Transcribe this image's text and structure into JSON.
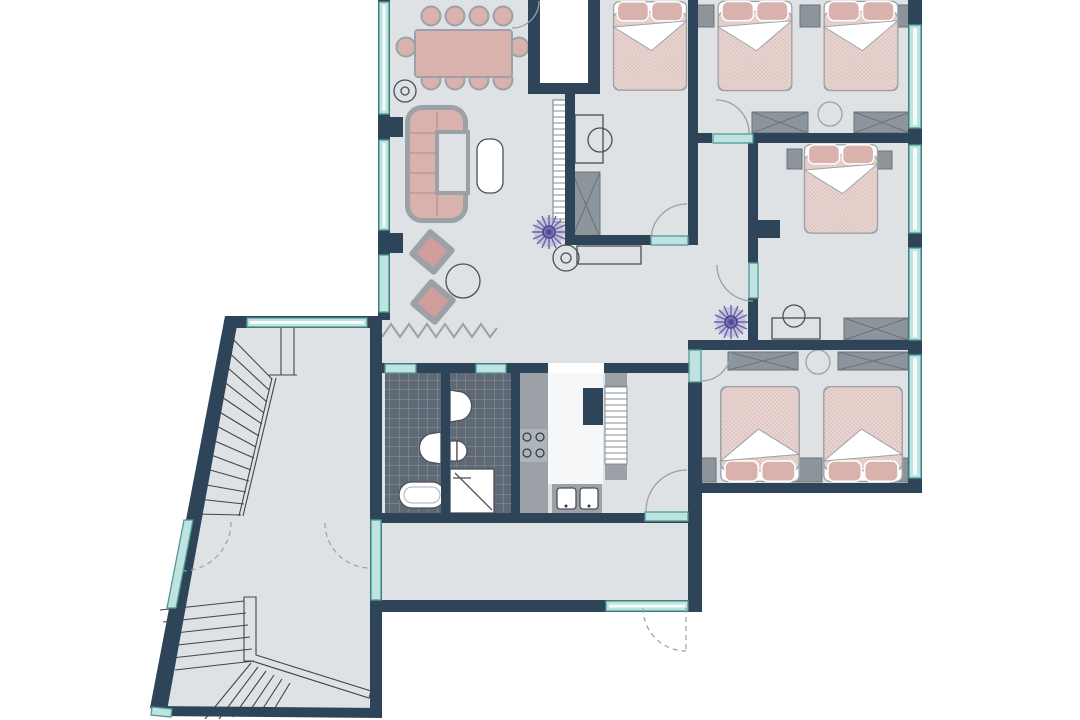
{
  "title": "apartment-floor-plan",
  "canvas": {
    "width": 1080,
    "height": 720,
    "background": "#ffffff"
  },
  "palette": {
    "wall": "#2e4459",
    "floor": "#dfe2e4",
    "window_frame": "#4f9a94",
    "window_fill": "#bfe3e0",
    "furniture_pink": "#d9b2ae",
    "furniture_gray": "#9ba1a7",
    "cabinet_gray": "#8d959c",
    "cabinet_stroke": "#6b7278",
    "tile_bg": "#5e6975",
    "tile_line": "#8d96a0",
    "plant_purple": "#6a62a8",
    "door_arc": "#98a1a9",
    "stair_line": "#3f454c",
    "line_dark": "#4a5057",
    "bed_blanket": "#e7d3cf",
    "bed_dot": "#d3b4b0"
  },
  "rooms": [
    {
      "id": "living-dining-room",
      "furniture": [
        "dining-table",
        "ten-chairs",
        "corner-sofa",
        "coffee-table",
        "two-poufs",
        "side-table",
        "sideboard",
        "plant",
        "rug-zigzag"
      ]
    },
    {
      "id": "bedroom-top-left",
      "furniture": [
        "double-bed",
        "desk",
        "chair",
        "wardrobe"
      ]
    },
    {
      "id": "bedroom-top-right",
      "furniture": [
        "double-bed",
        "double-bed",
        "nightstands",
        "two-wardrobes",
        "stool"
      ]
    },
    {
      "id": "bedroom-middle-right",
      "furniture": [
        "double-bed",
        "nightstands",
        "desk",
        "chair",
        "wardrobe"
      ]
    },
    {
      "id": "bedroom-bottom-right",
      "furniture": [
        "double-bed",
        "double-bed",
        "nightstands",
        "two-wardrobes",
        "stool"
      ]
    },
    {
      "id": "bathroom-left",
      "furniture": [
        "bathtub",
        "washbasin"
      ]
    },
    {
      "id": "bathroom-right",
      "furniture": [
        "washbasin",
        "toilet",
        "shower"
      ]
    },
    {
      "id": "kitchen",
      "furniture": [
        "counter",
        "stove",
        "double-sink",
        "radiator"
      ]
    },
    {
      "id": "hallway",
      "furniture": [
        "plant",
        "console"
      ]
    },
    {
      "id": "stair-hall",
      "furniture": [
        "staircase-upper",
        "staircase-lower"
      ]
    }
  ]
}
